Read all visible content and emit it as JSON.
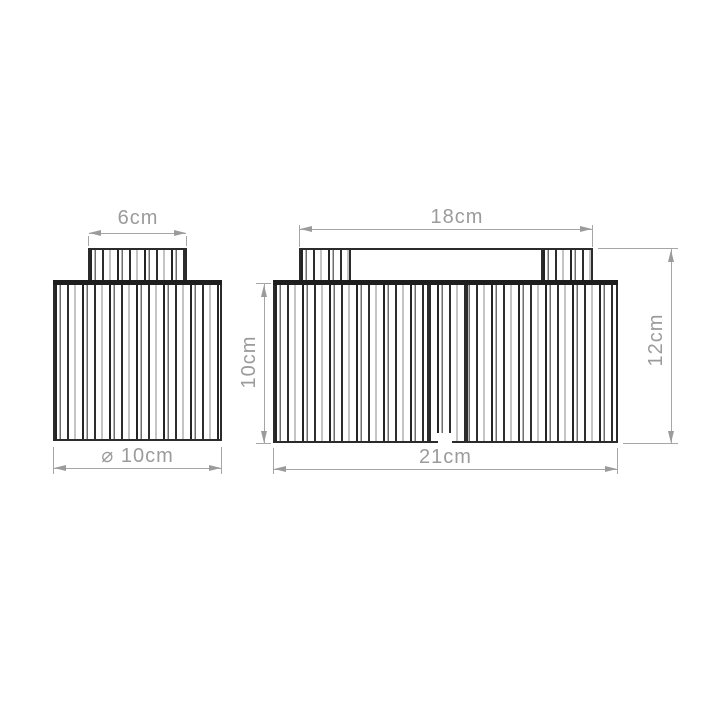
{
  "dimensions": {
    "left_top_width": {
      "label": "6cm"
    },
    "left_diameter": {
      "label": "⌀ 10cm"
    },
    "right_top_width": {
      "label": "18cm"
    },
    "right_shade_height": {
      "label": "10cm"
    },
    "right_total_height": {
      "label": "12cm"
    },
    "right_overall_width": {
      "label": "21cm"
    }
  },
  "colors": {
    "outline": "#2b2b2b",
    "dimension_line": "#a6a6a6",
    "dimension_text": "#9b9b9b",
    "background": "#ffffff"
  }
}
